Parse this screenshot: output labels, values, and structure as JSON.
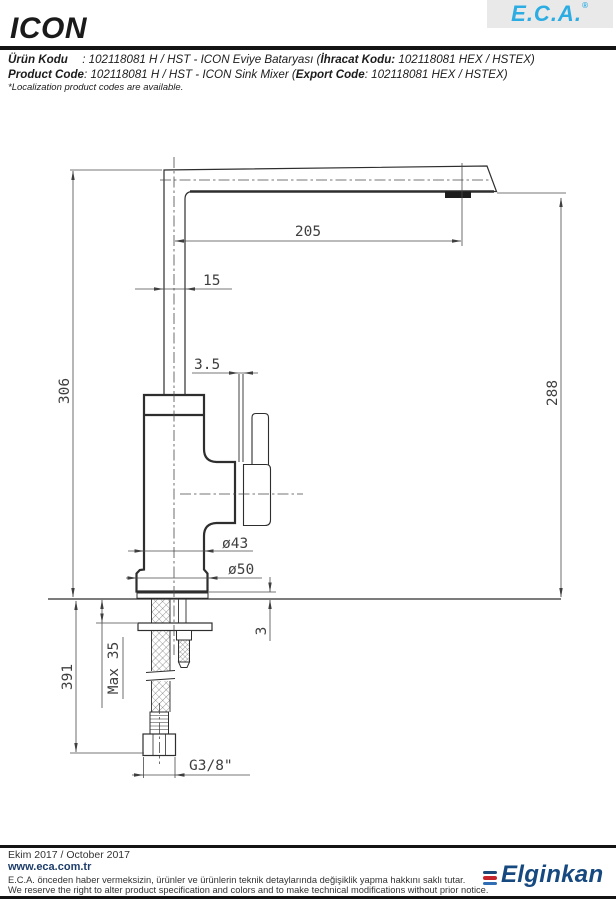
{
  "header": {
    "title": "ICON",
    "brand": "E.C.A.",
    "brand_reg": "®",
    "line1": {
      "label": "Ürün Kodu",
      "mid": " : 102118081 H / HST - ICON Eviye Bataryası (",
      "bold2": "İhracat Kodu:",
      "tail": " 102118081 HEX / HSTEX)"
    },
    "line2": {
      "label": "Product Code",
      "mid": ": 102118081 H / HST - ICON Sink Mixer (",
      "bold2": "Export Code",
      "tail": ": 102118081 HEX / HSTEX)"
    },
    "note": "*Localization product codes are available."
  },
  "drawing": {
    "dims": {
      "spout_reach": "205",
      "spout_tube": "15",
      "lever_blade": "3.5",
      "total_height": "306",
      "spout_height": "288",
      "body_dia": "ø43",
      "base_dia": "ø50",
      "base_plate": "3",
      "max_mount": "Max 35",
      "below_counter": "391",
      "thread": "G3/8\""
    }
  },
  "footer": {
    "date": "Ekim 2017 / October 2017",
    "url": "www.eca.com.tr",
    "note_tr": "E.C.A. önceden haber vermeksizin, ürünler ve ürünlerin teknik detaylarında değişiklik yapma hakkını saklı tutar.",
    "note_en": "We reserve the right to alter product specification and colors and to make technical modifications without prior notice.",
    "logo": "Elginkan"
  },
  "colors": {
    "eca_blue": "#2bace2",
    "elginkan_navy": "#1b4a7a",
    "elginkan_red": "#c5262c",
    "elginkan_blue": "#2f6db5",
    "line": "#2e2e2e"
  }
}
